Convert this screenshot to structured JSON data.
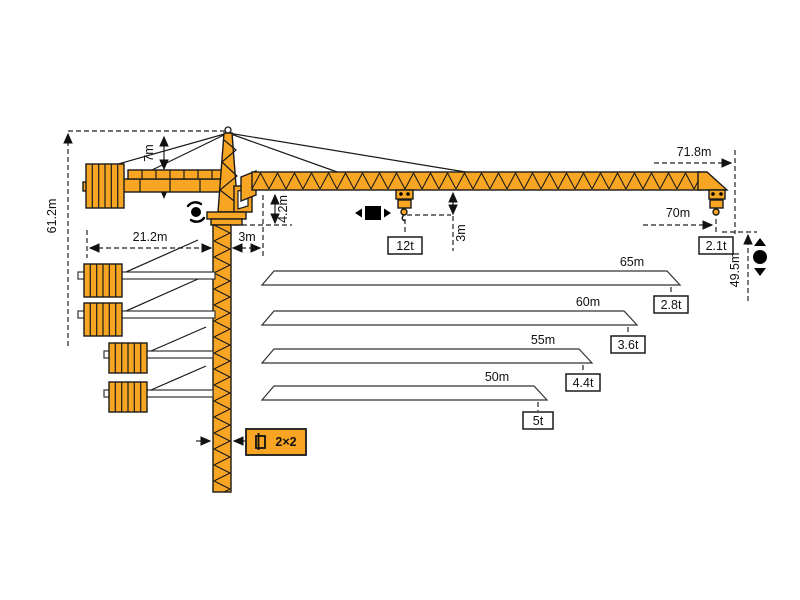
{
  "colors": {
    "crane_orange": "#F7A522",
    "outline_black": "#1a1a1a",
    "background": "#ffffff"
  },
  "dimensions": {
    "overall_height": "61.2m",
    "tower_head_height": "7m",
    "counter_jib_radius": "21.2m",
    "slew_offset": "3m",
    "jib_section_height": "4.2m",
    "hook_approach": "3m",
    "jib_tip_radius": "71.8m",
    "max_hook_radius": "70m",
    "hook_height": "49.5m"
  },
  "loads": {
    "max_capacity": "12t",
    "tip_capacity": "2.1t"
  },
  "tower": {
    "section_label": "2×2"
  },
  "jib_variants": [
    {
      "length": "65m",
      "capacity": "2.8t"
    },
    {
      "length": "60m",
      "capacity": "3.6t"
    },
    {
      "length": "55m",
      "capacity": "4.4t"
    },
    {
      "length": "50m",
      "capacity": "5t"
    }
  ],
  "icons": {
    "slewing": "slewing-rotation-icon",
    "trolley": "trolley-travel-icon",
    "hoist": "hoist-up-down-icon",
    "section": "tower-cross-section-icon"
  }
}
